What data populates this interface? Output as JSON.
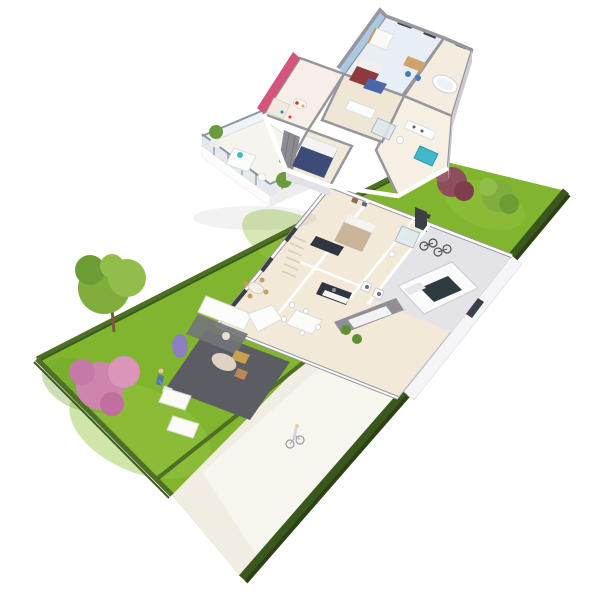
{
  "scene": {
    "kind": "isometric-3d-floor-plan-render",
    "background": "#ffffff",
    "floors": {
      "upper_rooms": [
        "bedroom-blue",
        "kids-room-pink",
        "master-bedroom",
        "bathroom-tub",
        "shower-room",
        "hallway",
        "balcony-terrace"
      ],
      "ground_rooms": [
        "living-dining-room",
        "kitchen",
        "staircase",
        "hallway",
        "bedroom",
        "shower-room",
        "laundry",
        "garage",
        "patio-terrace"
      ]
    },
    "garden_items": [
      "lawn",
      "ornamental-tree",
      "pink-flowering-shrub",
      "lavender-bush",
      "gardener-figure",
      "lawnmower",
      "sun-lounger",
      "sun-lounger",
      "perimeter-fence",
      "hedge"
    ],
    "vehicles": [
      "white-car",
      "bicycles",
      "cyclist-figure"
    ],
    "counts": {
      "sun_loungers": 2,
      "balcony_planters": 2,
      "upper_floor_beds": 3
    }
  },
  "colors": {
    "background": "#ffffff",
    "lawn": "#82b52e",
    "lawn_light": "#97c643",
    "lawn_dark": "#6da02a",
    "fence": "#4e7026",
    "hedge": "#3a571e",
    "hedge_dark": "#2c4214",
    "driveway": "#f1ede3",
    "driveway_light": "#f8f6f0",
    "floor": "#f2e9d8",
    "floor_light": "#f7f1e5",
    "terrace": "#5c5d63",
    "garage_floor": "#e4e3e7",
    "wall_top": "#96969c",
    "wall_face": "#ffffff",
    "wall_side": "#cbcbd1",
    "window_glass": "#3a4047",
    "accent_blue": "#a9c8e3",
    "accent_pink": "#d4547e",
    "bed_navy": "#3c4c77",
    "bed_red": "#8d3a3c",
    "bed_blue": "#4968a8",
    "bed_beige": "#cbb59a",
    "sofa_white": "#fcfcfb",
    "rug_gray": "#73747a",
    "wood": "#c79d63",
    "kitchen_dark": "#2f3642",
    "tree_green": "#7fae3c",
    "tree_green_dark": "#6d9c34",
    "tree_green_light": "#8fbf4a",
    "trunk_brown": "#7a5c3a",
    "blossom_pink": "#cd85ad",
    "blossom_pink_light": "#d996ba",
    "lavender": "#8d7fc0",
    "bush_red": "#8e4e5a",
    "teal": "#3fbdc5",
    "car_body": "#fafafa",
    "car_glass": "#2e3b40",
    "glass_rail": "#d3e2ec"
  }
}
